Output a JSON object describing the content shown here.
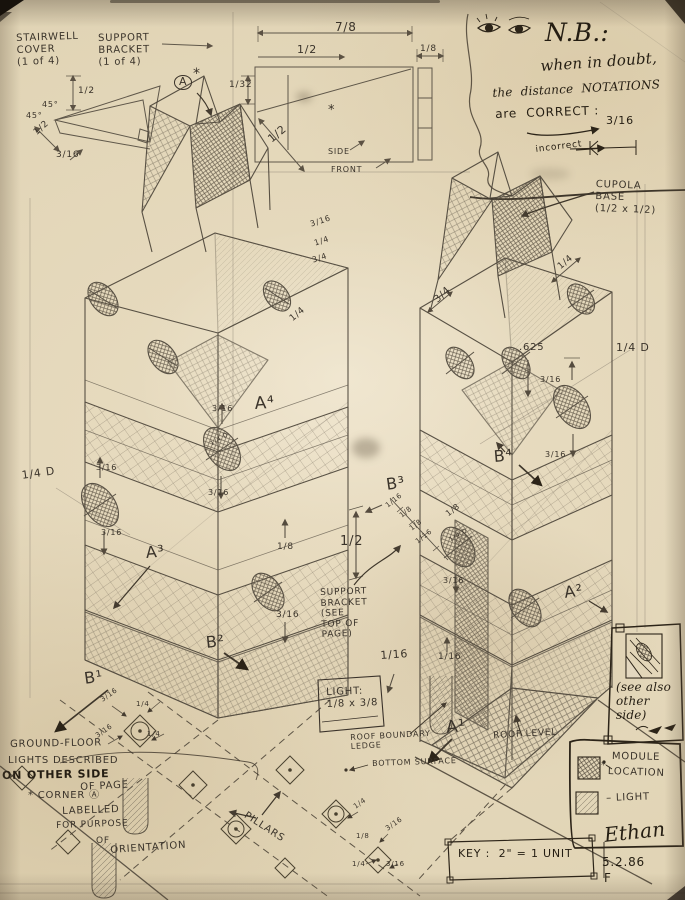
{
  "colors": {
    "paper": "#e6dabf",
    "pencil": "#494237",
    "ink": "#2c2418"
  },
  "annotations": [
    {
      "n": "stairwell-cover-note",
      "l": [
        "STAIRWELL",
        "COVER",
        "(1 of 4)"
      ],
      "x": 16,
      "y": 33,
      "s": 10,
      "r": -2
    },
    {
      "n": "support-bracket-note",
      "l": [
        "SUPPORT",
        "BRACKET",
        "(1 of 4)"
      ],
      "x": 98,
      "y": 33,
      "s": 10,
      "r": -1
    },
    {
      "n": "dim-stairwell-height",
      "t": "1/2",
      "x": 78,
      "y": 86,
      "s": 9
    },
    {
      "n": "dim-stairwell-width",
      "t": "1/2",
      "x": 32,
      "y": 130,
      "s": 9,
      "r": -42
    },
    {
      "n": "dim-stairwell-lip",
      "t": "3/16",
      "x": 56,
      "y": 150,
      "s": 9
    },
    {
      "n": "stairwell-angle-1",
      "t": "45°",
      "x": 42,
      "y": 100,
      "s": 8
    },
    {
      "n": "stairwell-angle-2",
      "t": "45°",
      "x": 26,
      "y": 111,
      "s": 8
    },
    {
      "n": "corner-a-circled",
      "t": "A",
      "x": 174,
      "y": 75,
      "s": 11,
      "c": "circ"
    },
    {
      "n": "corner-a-asterisk",
      "t": "*",
      "x": 193,
      "y": 66,
      "s": 14
    },
    {
      "n": "dim-top-width",
      "t": "7/8",
      "x": 335,
      "y": 20,
      "s": 12
    },
    {
      "n": "dim-top-half",
      "t": "1/2",
      "x": 297,
      "y": 44,
      "s": 11
    },
    {
      "n": "dim-top-eighth",
      "t": "1/8",
      "x": 420,
      "y": 44,
      "s": 9
    },
    {
      "n": "dim-top-132",
      "t": "1/32",
      "x": 229,
      "y": 80,
      "s": 9
    },
    {
      "n": "dim-top-diag-half",
      "t": "1/2",
      "x": 266,
      "y": 136,
      "s": 11,
      "r": -40
    },
    {
      "n": "mark-asterisk-side",
      "t": "*",
      "x": 328,
      "y": 103,
      "s": 13
    },
    {
      "n": "side-label",
      "t": "SIDE",
      "x": 328,
      "y": 147,
      "s": 8
    },
    {
      "n": "front-label",
      "t": "FRONT",
      "x": 331,
      "y": 165,
      "s": 8
    },
    {
      "n": "nb-heading",
      "t": "N.B.:",
      "x": 545,
      "y": 18,
      "s": 25,
      "c": "script ink"
    },
    {
      "n": "nb-line1",
      "t": "when in doubt,",
      "x": 540,
      "y": 58,
      "s": 15,
      "r": -4,
      "c": "script ink"
    },
    {
      "n": "nb-line2",
      "t": "the  distance  NOTATIONS",
      "x": 492,
      "y": 86,
      "s": 12,
      "r": -3,
      "c": "script ink"
    },
    {
      "n": "nb-line3",
      "t": "are  CORRECT :",
      "x": 495,
      "y": 107,
      "s": 12,
      "r": -2,
      "c": "ink"
    },
    {
      "n": "nb-correct-value",
      "t": "3/16",
      "x": 606,
      "y": 115,
      "s": 11,
      "c": "ink"
    },
    {
      "n": "nb-incorrect",
      "t": "incorrect",
      "x": 535,
      "y": 145,
      "s": 9,
      "r": -7,
      "c": "ink"
    },
    {
      "n": "cupola-base-note",
      "l": [
        "CUPOLA",
        "BASE",
        "(1/2 x 1/2)"
      ],
      "x": 596,
      "y": 179,
      "s": 10,
      "r": 2
    },
    {
      "n": "dim-cupola-quarter",
      "t": "1/4",
      "x": 556,
      "y": 264,
      "s": 9,
      "r": -40
    },
    {
      "n": "dim-left-col-316",
      "t": "3/16",
      "x": 309,
      "y": 220,
      "s": 8,
      "r": -18
    },
    {
      "n": "dim-left-col-quarter",
      "t": "1/4",
      "x": 313,
      "y": 239,
      "s": 8,
      "r": -18
    },
    {
      "n": "dim-left-col-34",
      "t": "3/4",
      "x": 311,
      "y": 256,
      "s": 8,
      "r": -18
    },
    {
      "n": "dim-left-face-quarter",
      "t": "1/4",
      "x": 288,
      "y": 316,
      "s": 9,
      "r": -40
    },
    {
      "n": "dim-right-col-34",
      "t": "3/4",
      "x": 432,
      "y": 297,
      "s": 10,
      "r": -42
    },
    {
      "n": "dim-625",
      "t": ".625",
      "x": 519,
      "y": 342,
      "s": 10
    },
    {
      "n": "dim-quarter-d-margin",
      "t": "1/4 D",
      "x": 616,
      "y": 342,
      "s": 11
    },
    {
      "n": "dim-rt-316-upper",
      "t": "3/16",
      "x": 540,
      "y": 375,
      "s": 8
    },
    {
      "n": "dim-rt-316-lower",
      "t": "3/16",
      "x": 545,
      "y": 450,
      "s": 8
    },
    {
      "n": "label-b4",
      "t": "B⁴",
      "x": 493,
      "y": 448,
      "s": 16,
      "r": -5
    },
    {
      "n": "label-b3",
      "t": "B³",
      "x": 385,
      "y": 476,
      "s": 16,
      "r": -8
    },
    {
      "n": "dim-b3-116a",
      "t": "1/16",
      "x": 384,
      "y": 503,
      "s": 7,
      "r": -38
    },
    {
      "n": "dim-b3-18a",
      "t": "1/8",
      "x": 398,
      "y": 513,
      "s": 7,
      "r": -38
    },
    {
      "n": "dim-b3-18b",
      "t": "1/8",
      "x": 408,
      "y": 526,
      "s": 7,
      "r": -38
    },
    {
      "n": "dim-b3-116b",
      "t": "1/16",
      "x": 414,
      "y": 539,
      "s": 7,
      "r": -38
    },
    {
      "n": "dim-b3-18c",
      "t": "1/8",
      "x": 444,
      "y": 511,
      "s": 8,
      "r": -38
    },
    {
      "n": "dim-half-center",
      "t": "1/2",
      "x": 340,
      "y": 534,
      "s": 13
    },
    {
      "n": "dim-ellipse-316-low",
      "t": "3/16",
      "x": 443,
      "y": 576,
      "s": 8
    },
    {
      "n": "label-a4",
      "t": "A⁴",
      "x": 254,
      "y": 394,
      "s": 17,
      "r": -4
    },
    {
      "n": "dim-a4-316-up",
      "t": "3/16",
      "x": 212,
      "y": 404,
      "s": 8
    },
    {
      "n": "dim-a4-316-low",
      "t": "3/16",
      "x": 208,
      "y": 488,
      "s": 8
    },
    {
      "n": "dim-quarter-d-left",
      "t": "1/4 D",
      "x": 21,
      "y": 470,
      "s": 11,
      "r": -8
    },
    {
      "n": "dim-l-ellipse-316-up",
      "t": "3/16",
      "x": 96,
      "y": 463,
      "s": 8
    },
    {
      "n": "dim-l-ellipse-316-low",
      "t": "3/16",
      "x": 101,
      "y": 528,
      "s": 8
    },
    {
      "n": "label-a3",
      "t": "A³",
      "x": 145,
      "y": 544,
      "s": 16,
      "r": -5
    },
    {
      "n": "dim-18-mid",
      "t": "1/8",
      "x": 277,
      "y": 542,
      "s": 9
    },
    {
      "n": "dim-316-mid",
      "t": "3/16",
      "x": 276,
      "y": 610,
      "s": 9
    },
    {
      "n": "label-b2",
      "t": "B²",
      "x": 205,
      "y": 634,
      "s": 16,
      "r": -6
    },
    {
      "n": "label-b1",
      "t": "B¹",
      "x": 83,
      "y": 670,
      "s": 16,
      "r": -8
    },
    {
      "n": "support-bracket-see-note",
      "l": [
        "SUPPORT",
        "BRACKET",
        "(SEE",
        "TOP OF",
        "PAGE)"
      ],
      "x": 320,
      "y": 588,
      "s": 9,
      "r": -2
    },
    {
      "n": "dim-116-left",
      "t": "1/16",
      "x": 380,
      "y": 650,
      "s": 11,
      "r": -4
    },
    {
      "n": "dim-116-right",
      "t": "1/16",
      "x": 438,
      "y": 652,
      "s": 9
    },
    {
      "n": "light-callout-note",
      "l": [
        "LIGHT:",
        "1/8 x 3/8"
      ],
      "x": 326,
      "y": 687,
      "s": 10,
      "r": -2
    },
    {
      "n": "roof-boundary-note",
      "l": [
        "ROOF BOUNDARY",
        "LEDGE"
      ],
      "x": 350,
      "y": 733,
      "s": 8,
      "r": -3
    },
    {
      "n": "bottom-surface-note",
      "t": "BOTTOM SURFACE",
      "x": 372,
      "y": 759,
      "s": 8,
      "r": -2
    },
    {
      "n": "label-a1",
      "t": "A¹",
      "x": 445,
      "y": 718,
      "s": 17,
      "r": -6
    },
    {
      "n": "label-a2",
      "t": "A²",
      "x": 563,
      "y": 584,
      "s": 16,
      "r": -8
    },
    {
      "n": "roof-level-note",
      "t": "ROOF LEVEL",
      "x": 493,
      "y": 731,
      "s": 9,
      "r": -3
    },
    {
      "n": "see-also-note",
      "l": [
        "(see also",
        "other",
        "side)"
      ],
      "x": 616,
      "y": 680,
      "s": 12,
      "c": "script ink"
    },
    {
      "n": "ground-floor-note-1",
      "t": "GROUND-FLOOR",
      "x": 10,
      "y": 739,
      "s": 10,
      "r": -1
    },
    {
      "n": "ground-floor-note-2",
      "t": "LIGHTS DESCRIBED",
      "x": 8,
      "y": 755,
      "s": 10
    },
    {
      "n": "ground-floor-note-3",
      "t": "ON OTHER SIDE",
      "x": 2,
      "y": 770,
      "s": 11,
      "r": -1,
      "c": "ink bold"
    },
    {
      "n": "ground-floor-note-4",
      "t": "OF PAGE",
      "x": 80,
      "y": 782,
      "s": 10,
      "r": -3
    },
    {
      "n": "corner-note-1",
      "t": "* CORNER Ⓐ",
      "x": 28,
      "y": 790,
      "s": 10
    },
    {
      "n": "corner-note-2",
      "t": "LABELLED",
      "x": 62,
      "y": 806,
      "s": 10,
      "r": -2
    },
    {
      "n": "corner-note-3",
      "t": "FOR PURPOSE",
      "x": 56,
      "y": 821,
      "s": 9,
      "r": -2
    },
    {
      "n": "corner-note-4",
      "t": "OF",
      "x": 96,
      "y": 836,
      "s": 9
    },
    {
      "n": "corner-note-5",
      "t": "ORIENTATION",
      "x": 110,
      "y": 845,
      "s": 10,
      "r": -4
    },
    {
      "n": "pillars-note",
      "t": "PILLARS",
      "x": 248,
      "y": 810,
      "s": 10,
      "r": 33
    },
    {
      "n": "legend-module-label-1",
      "t": "MODULE",
      "x": 612,
      "y": 751,
      "s": 10,
      "r": 1
    },
    {
      "n": "legend-module-label-2",
      "t": "LOCATION",
      "x": 608,
      "y": 766,
      "s": 10,
      "r": 2
    },
    {
      "n": "legend-module-asterisk",
      "t": "*",
      "x": 601,
      "y": 760,
      "s": 10
    },
    {
      "n": "legend-light-label",
      "t": "– LIGHT",
      "x": 606,
      "y": 793,
      "s": 10,
      "r": -2
    },
    {
      "n": "key-note",
      "t": "KEY :  2\" = 1 UNIT",
      "x": 458,
      "y": 848,
      "s": 11,
      "c": "ink"
    },
    {
      "n": "signature-name",
      "t": "Ethan",
      "x": 603,
      "y": 824,
      "s": 20,
      "r": -6,
      "c": "script ink"
    },
    {
      "n": "signature-date",
      "t": "5.2.86",
      "x": 602,
      "y": 855,
      "s": 12,
      "c": "ink"
    },
    {
      "n": "signature-initial",
      "t": "F",
      "x": 604,
      "y": 871,
      "s": 12,
      "c": "ink"
    },
    {
      "n": "dim-pillar-l-316-top",
      "t": "3/16",
      "x": 99,
      "y": 697,
      "s": 7,
      "r": -35
    },
    {
      "n": "dim-pillar-l-quarter-top",
      "t": "1/4",
      "x": 136,
      "y": 700,
      "s": 7
    },
    {
      "n": "dim-pillar-l-316-bottom",
      "t": "3/16",
      "x": 94,
      "y": 733,
      "s": 7,
      "r": -35
    },
    {
      "n": "dim-pillar-l-quarter-bottom",
      "t": "1/4",
      "x": 147,
      "y": 730,
      "s": 7
    },
    {
      "n": "dim-pillar-r-quarter-1",
      "t": "1/4",
      "x": 352,
      "y": 804,
      "s": 7,
      "r": -35
    },
    {
      "n": "dim-pillar-r-316-1",
      "t": "3/16",
      "x": 384,
      "y": 826,
      "s": 7,
      "r": -35
    },
    {
      "n": "dim-pillar-r-eighth",
      "t": "1/8",
      "x": 356,
      "y": 832,
      "s": 7
    },
    {
      "n": "dim-pillar-r-quarter-2",
      "t": "1/4",
      "x": 352,
      "y": 860,
      "s": 7
    },
    {
      "n": "dim-pillar-r-316-2",
      "t": "3/16",
      "x": 386,
      "y": 860,
      "s": 7
    },
    {
      "n": "dim-quarter-d-in-left-ellipse",
      "t": "1/4 D",
      "x": 209,
      "y": 441,
      "s": 6,
      "r": -30
    },
    {
      "n": "dim-quarter-d-in-right-ellipse",
      "t": "1/4 D",
      "x": 448,
      "y": 537,
      "s": 6,
      "r": -30
    }
  ]
}
